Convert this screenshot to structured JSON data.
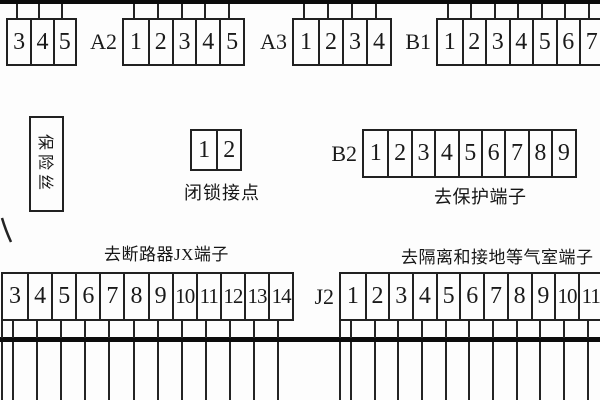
{
  "palette": {
    "background": "#fdfdfd",
    "line": "#212121",
    "bus_bar": "#0b0b0b",
    "text": "#161616"
  },
  "labels": {
    "fuse": "保险丝",
    "interlock": "闭锁接点",
    "to_protection": "去保护端子",
    "to_breaker": "去断路器JX端子",
    "to_isolation": "去隔离和接地等气室端子"
  },
  "bars": {
    "top": {
      "x": 0,
      "y": 0,
      "w": 600,
      "h": 4
    },
    "bottom": {
      "x": 0,
      "y": 337,
      "w": 600,
      "h": 5
    }
  },
  "wire_geometry": {
    "up": {
      "y1": 4,
      "y2": 19
    },
    "down_stub": {
      "y1": 321,
      "y2": 338
    },
    "down_line": {
      "y1": 342,
      "y2": 400
    }
  },
  "blocks": [
    {
      "name": "top-strip-1",
      "label": "",
      "cells": [
        "3",
        "4",
        "5"
      ],
      "x": 6,
      "y": 18,
      "cell_w": 22.3,
      "h": 48,
      "wires": "up"
    },
    {
      "name": "top-strip-a2",
      "label": "A2",
      "cells": [
        "1",
        "2",
        "3",
        "4",
        "5"
      ],
      "x": 122,
      "y": 18,
      "cell_w": 23.8,
      "h": 48,
      "wires": "up"
    },
    {
      "name": "top-strip-a3",
      "label": "A3",
      "cells": [
        "1",
        "2",
        "3",
        "4"
      ],
      "x": 292,
      "y": 18,
      "cell_w": 24,
      "h": 48,
      "wires": "up"
    },
    {
      "name": "top-strip-b1",
      "label": "B1",
      "cells": [
        "1",
        "2",
        "3",
        "4",
        "5",
        "6",
        "7"
      ],
      "x": 436,
      "y": 18,
      "cell_w": 23.5,
      "h": 48,
      "wires": "up"
    },
    {
      "name": "interlock-contact-block",
      "label": "",
      "cells": [
        "1",
        "2"
      ],
      "x": 190,
      "y": 129,
      "cell_w": 24.2,
      "h": 42,
      "wires": "none"
    },
    {
      "name": "b2-strip",
      "label": "B2",
      "cells": [
        "1",
        "2",
        "3",
        "4",
        "5",
        "6",
        "7",
        "8",
        "9"
      ],
      "x": 362,
      "y": 129,
      "cell_w": 23.4,
      "h": 49,
      "wires": "none"
    },
    {
      "name": "breaker-jx-strip",
      "label": "",
      "cells": [
        "3",
        "4",
        "5",
        "6",
        "7",
        "8",
        "9",
        "10",
        "11",
        "12",
        "13",
        "14"
      ],
      "x": 1,
      "y": 272,
      "cell_w": 24.1,
      "h": 49,
      "wires": "down"
    },
    {
      "name": "j2-strip",
      "label": "J2",
      "cells": [
        "1",
        "2",
        "3",
        "4",
        "5",
        "6",
        "7",
        "8",
        "9",
        "10",
        "11"
      ],
      "x": 339,
      "y": 272,
      "cell_w": 23.7,
      "h": 49,
      "wires": "down"
    }
  ],
  "edge_wires": [
    {
      "x": 2
    },
    {
      "x": 340
    }
  ],
  "stray_stroke": {
    "x1": 2,
    "y1": 8,
    "x2": 11,
    "y2": 32
  }
}
